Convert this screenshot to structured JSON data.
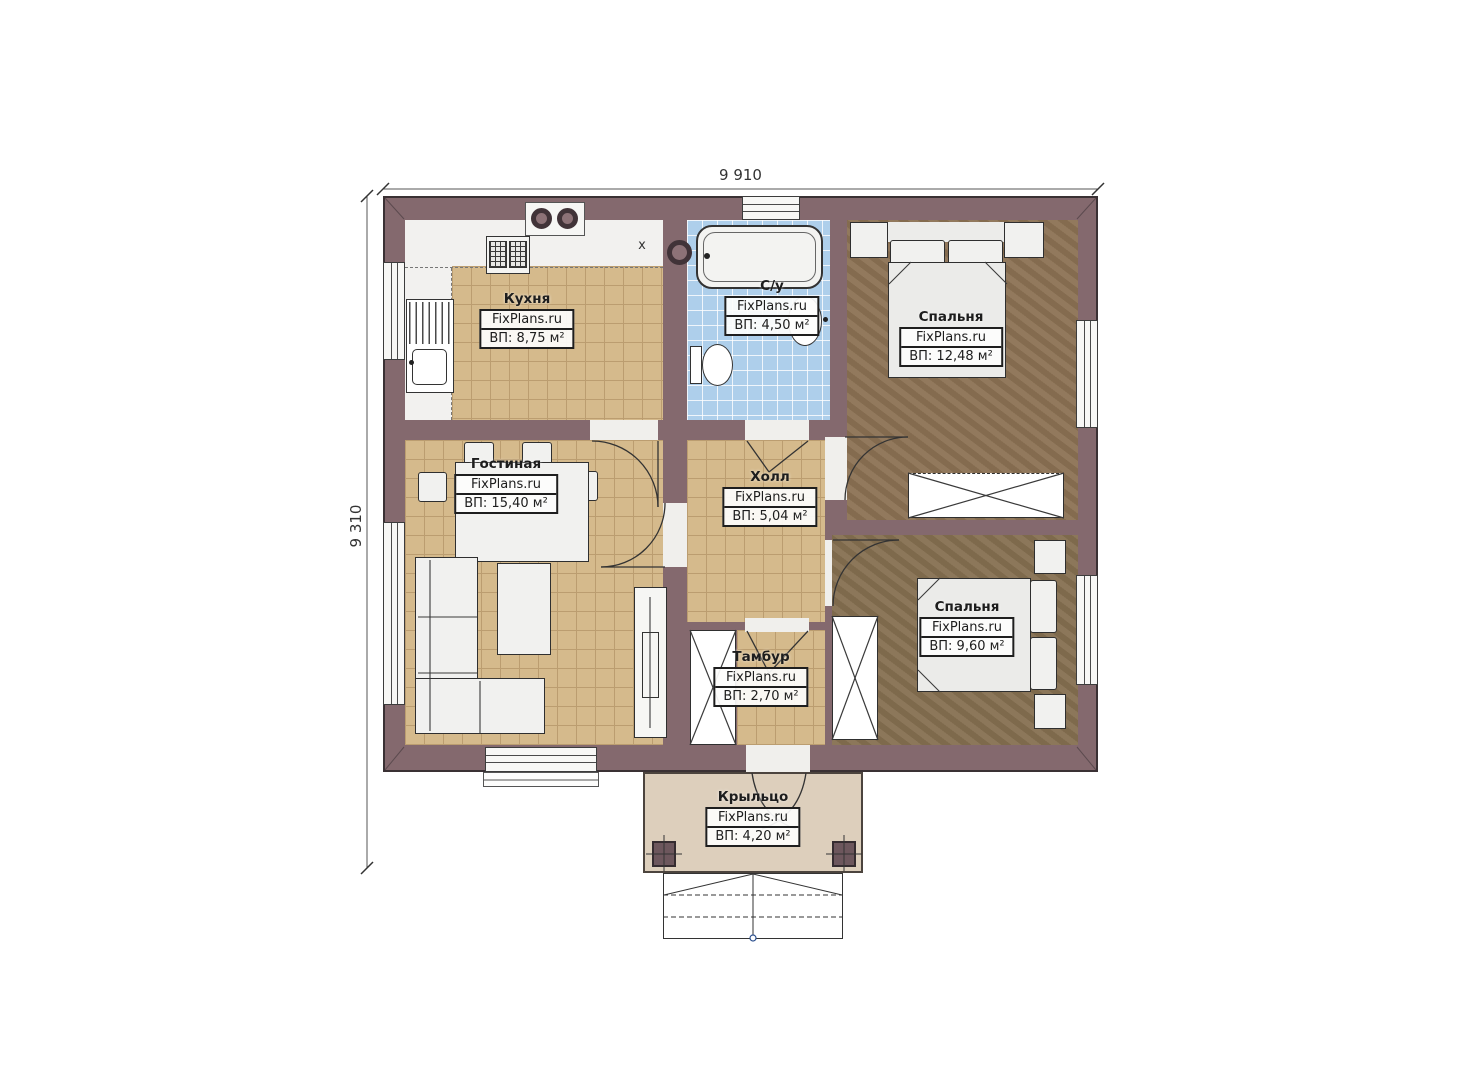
{
  "plan": {
    "dimensions": {
      "top": "9 910",
      "left": "9 310"
    },
    "watermark": "FixPlans.ru",
    "rooms": {
      "kitchen": {
        "name": "Кухня",
        "area": "ВП: 8,75 м²"
      },
      "bathroom": {
        "name": "С/у",
        "area": "ВП: 4,50 м²"
      },
      "bedroom1": {
        "name": "Спальня",
        "area": "ВП: 12,48 м²"
      },
      "living": {
        "name": "Гостиная",
        "area": "ВП: 15,40 м²"
      },
      "hall": {
        "name": "Холл",
        "area": "ВП: 5,04 м²"
      },
      "bedroom2": {
        "name": "Спальня",
        "area": "ВП: 9,60 м²"
      },
      "tambour": {
        "name": "Тамбур",
        "area": "ВП: 2,70 м²"
      },
      "porch": {
        "name": "Крыльцо",
        "area": "ВП: 4,20 м²"
      }
    },
    "symbols": {
      "counter_mark": "х"
    }
  },
  "colors": {
    "wall": "#84696e",
    "wall_line": "#3a3134",
    "floor_tan": "#d5ba8c",
    "tan_grid": "#bb9d70",
    "floor_blue": "#aecfeb",
    "floor_bedroom1": "#8c7254",
    "floor_bedroom2": "#867051",
    "porch": "#ddcfbc"
  }
}
